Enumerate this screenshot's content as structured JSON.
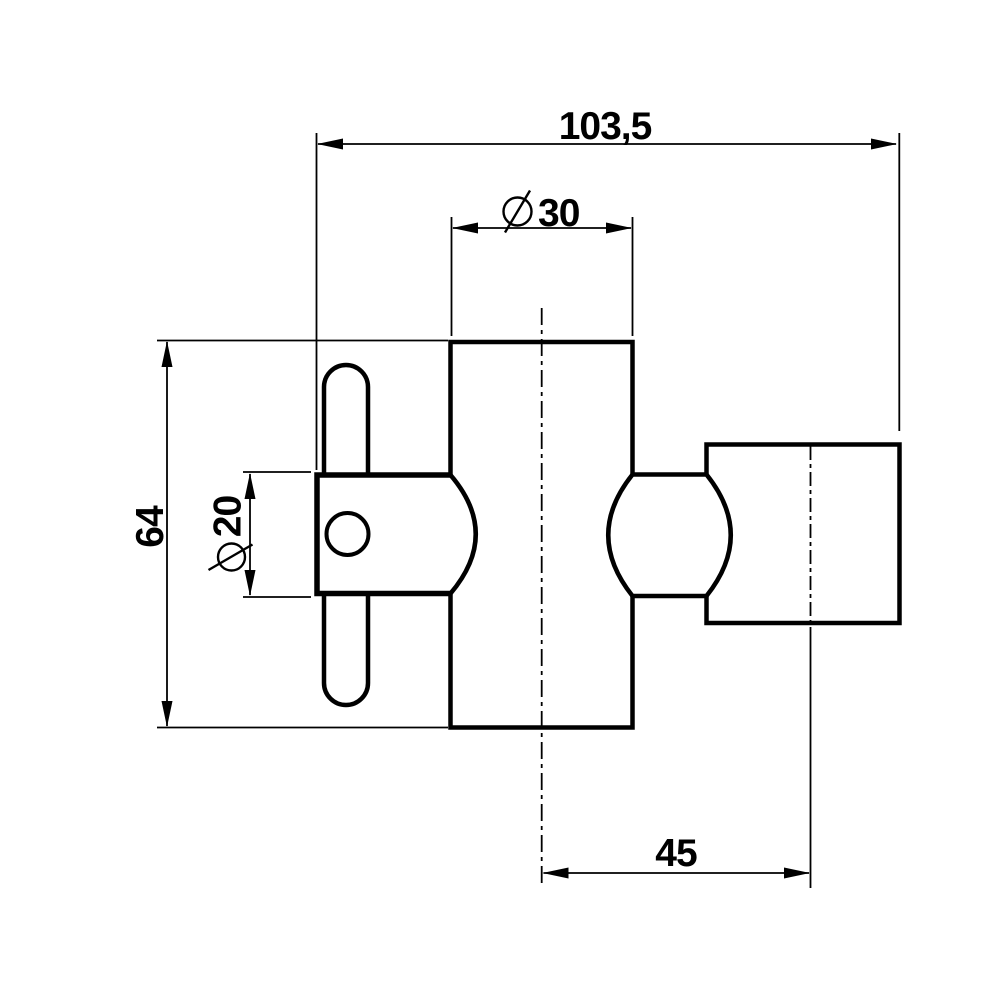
{
  "canvas": {
    "background": "#ffffff",
    "line_color": "#000000",
    "kind": "technical dimension drawing"
  },
  "dimensions": {
    "overall_width": {
      "label": "103,5"
    },
    "tube_diameter": {
      "symbol": "⌀",
      "label": "30"
    },
    "overall_height": {
      "label": "64"
    },
    "clamp_diameter": {
      "symbol": "⌀",
      "label": "20"
    },
    "rail_center_offset": {
      "label": "45"
    }
  },
  "parts": {
    "tube_body": "tube-body",
    "clamp_block": "clamp-block",
    "clamp_hole": "clamp-hole",
    "pin_handle": "pin-handle",
    "ball_joint": "ball-joint",
    "rail_holder": "rail-holder"
  }
}
